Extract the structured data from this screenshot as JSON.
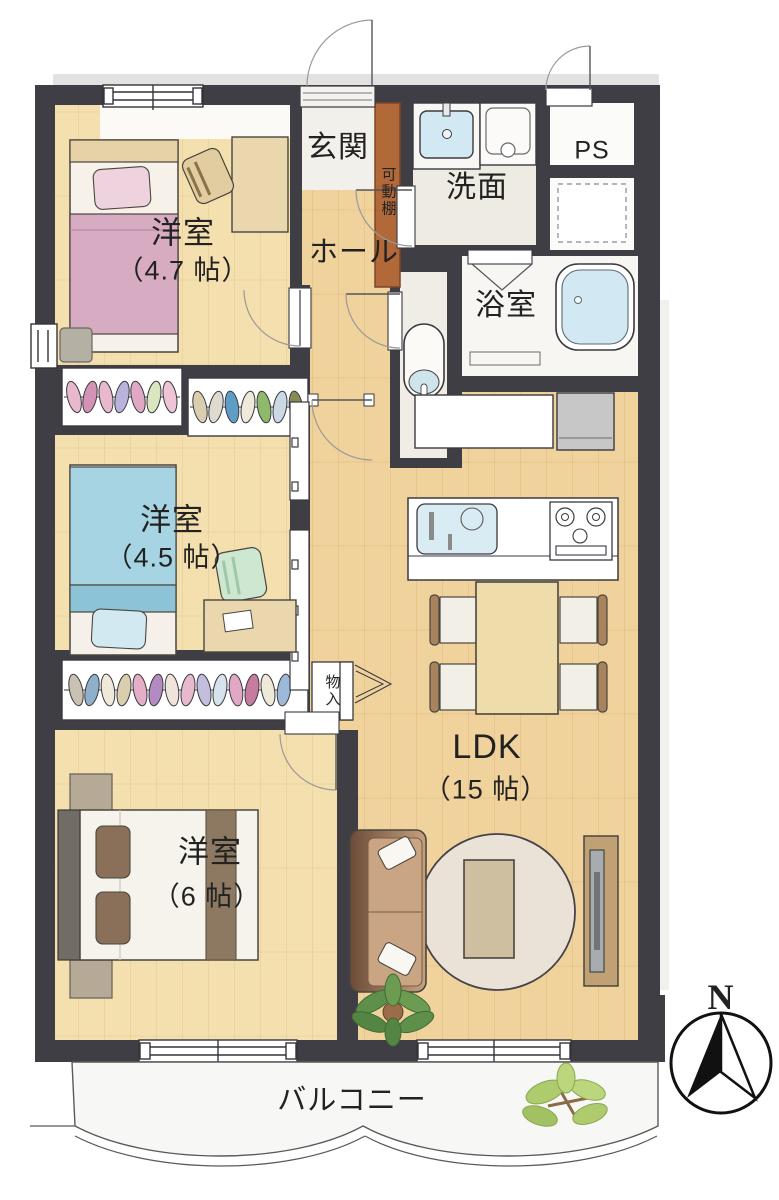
{
  "floorplan": {
    "rooms": [
      {
        "id": "room1",
        "name": "洋室",
        "size": "（4.7 帖）"
      },
      {
        "id": "room2",
        "name": "洋室",
        "size": "（4.5 帖）"
      },
      {
        "id": "room3",
        "name": "洋室",
        "size": "（6 帖）"
      },
      {
        "id": "ldk",
        "name": "LDK",
        "size": "（15 帖）"
      }
    ],
    "labels": {
      "entrance": "玄関",
      "movable_shelf": "可動棚",
      "washroom": "洗面",
      "pipe_space": "PS",
      "bathroom": "浴室",
      "hall": "ホール",
      "storage": "物入",
      "balcony": "バルコニー",
      "compass_north": "N"
    },
    "icons": {
      "compass": "compass-north-icon",
      "bathtub": "bathtub-icon",
      "toilet": "toilet-icon",
      "washbasin": "washbasin-icon",
      "washing_machine": "washing-machine-icon",
      "kitchen_sink": "kitchen-sink-icon",
      "stove": "stove-icon",
      "refrigerator": "refrigerator-icon",
      "dining_table": "dining-table-icon",
      "sofa": "sofa-icon",
      "tv_board": "tv-board-icon",
      "bed": "bed-icon",
      "desk": "desk-icon",
      "closet_clothes": "closet-clothes-icon",
      "plant": "plant-icon"
    },
    "colors": {
      "wall": "#3f3e44",
      "wood_light": "#f4dfae",
      "wood_dark": "#f0d29c",
      "tile": "#efece4",
      "bed_pink": "#d7abc1",
      "bed_blue": "#a7d4e2",
      "bath_water": "#d2e9f3",
      "shelf_brown": "#b2693a",
      "sofa_brown": "#6d4c38",
      "plant_dark": "#5e8f4b",
      "plant_light": "#aecb6d",
      "compass": "#111111"
    }
  }
}
